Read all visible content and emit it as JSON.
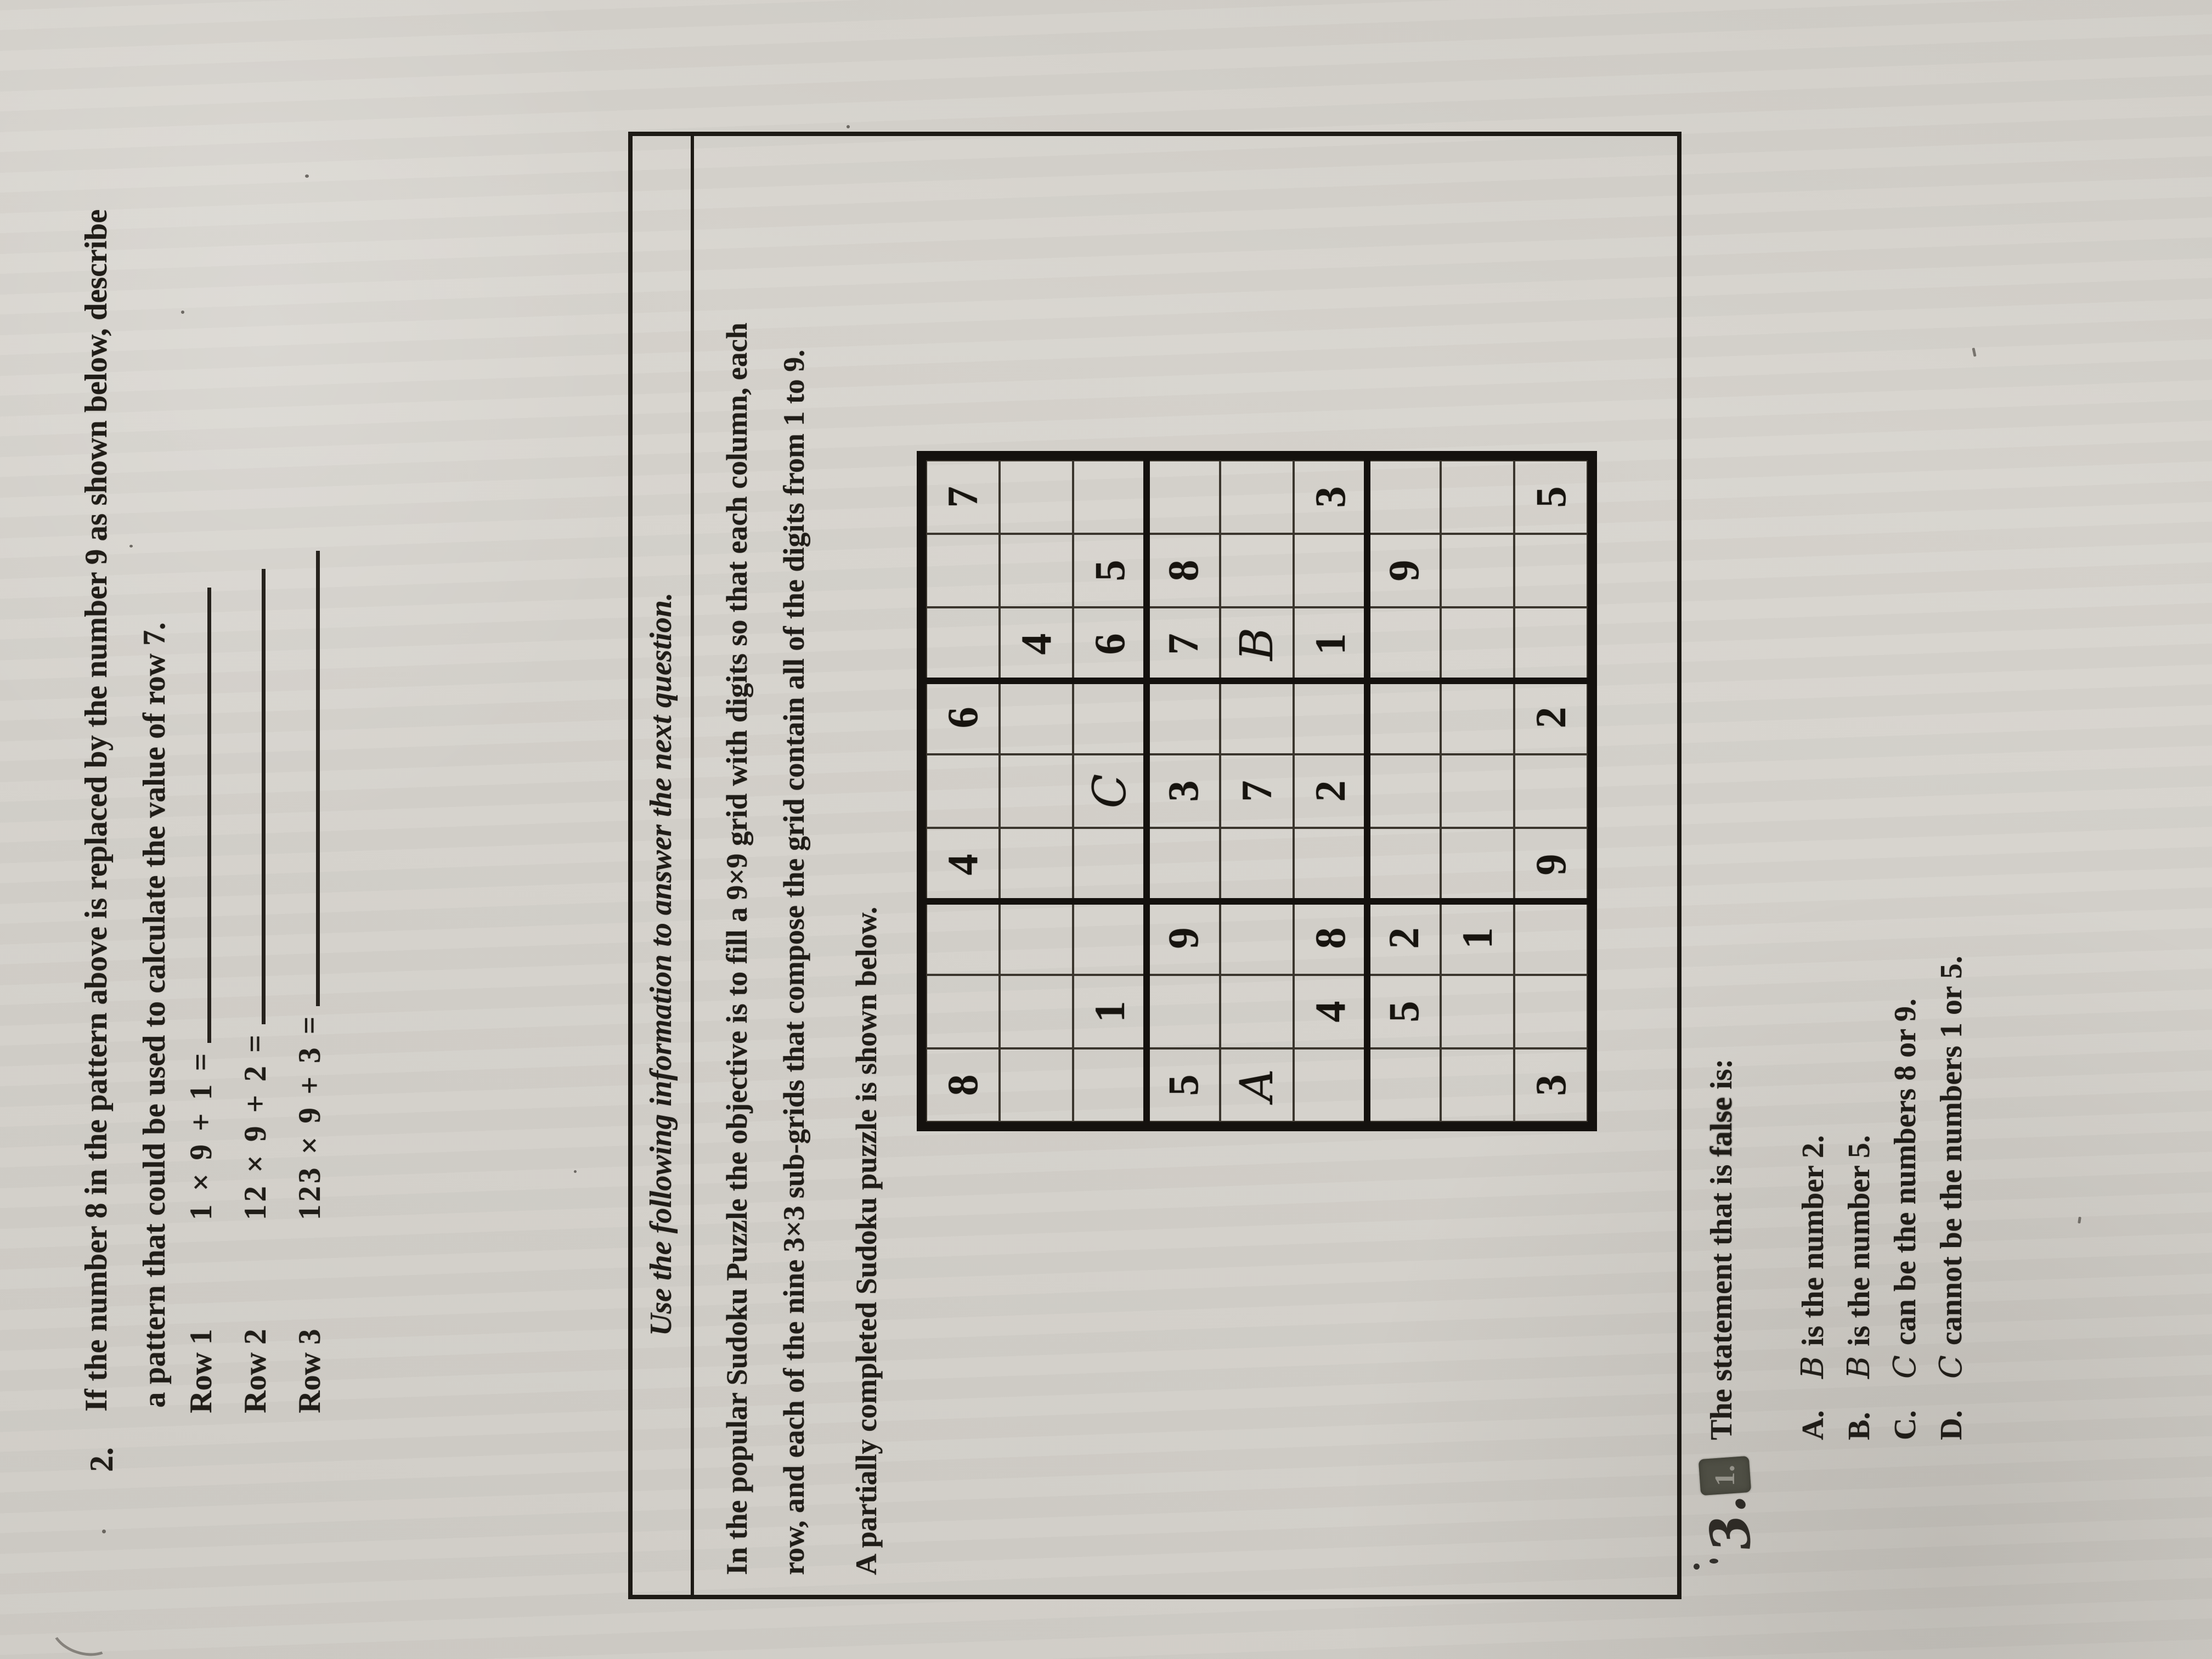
{
  "colors": {
    "paper": "#d3d0ca",
    "ink": "#201d18",
    "pencil_mark": "#4e4e44",
    "pen": "#2e2b26"
  },
  "question2": {
    "number": "2.",
    "line1": "If the number 8 in the pattern above is replaced by the number 9 as shown below, describe",
    "line2": "a pattern that could be used to calculate the value of row 7.",
    "rows": [
      {
        "label": "Row 1",
        "expression": "1 × 9 + 1 ="
      },
      {
        "label": "Row 2",
        "expression": "12 × 9 + 2 ="
      },
      {
        "label": "Row 3",
        "expression": "123 × 9 + 3 ="
      }
    ]
  },
  "info_box": {
    "heading": "Use the following information to answer the next question.",
    "line1": "In the popular Sudoku Puzzle the objective is to fill a 9×9 grid with digits so that each column, each",
    "line2": "row, and each of the nine 3×3 sub-grids that compose the grid contain all of the digits from 1 to 9.",
    "subtext": "A partially completed Sudoku puzzle is shown below."
  },
  "sudoku": {
    "grid": [
      [
        "8",
        "",
        "",
        "4",
        "",
        "6",
        "",
        "",
        "7"
      ],
      [
        "",
        "",
        "",
        "",
        "",
        "",
        "4",
        "",
        ""
      ],
      [
        "",
        "1",
        "",
        "",
        "C",
        "",
        "6",
        "5",
        ""
      ],
      [
        "5",
        "",
        "9",
        "",
        "3",
        "",
        "7",
        "8",
        ""
      ],
      [
        "A",
        "",
        "",
        "",
        "7",
        "",
        "B",
        "",
        ""
      ],
      [
        "",
        "4",
        "8",
        "",
        "2",
        "",
        "1",
        "",
        "3"
      ],
      [
        "",
        "5",
        "2",
        "",
        "",
        "",
        "",
        "9",
        ""
      ],
      [
        "",
        "",
        "1",
        "",
        "",
        "",
        "",
        "",
        ""
      ],
      [
        "3",
        "",
        "",
        "9",
        "",
        "2",
        "",
        "",
        "5"
      ]
    ]
  },
  "question3": {
    "number_handwritten": "3.",
    "covered_number": "1.",
    "stem_pre": "The statement that is ",
    "stem_bold": "false",
    "stem_post": " is:",
    "options": [
      {
        "letter": "A.",
        "subject": "B",
        "text": "is the number 2."
      },
      {
        "letter": "B.",
        "subject": "B",
        "text": "is the number 5."
      },
      {
        "letter": "C.",
        "subject": "C",
        "text": "can be the numbers 8 or 9."
      },
      {
        "letter": "D.",
        "subject": "C",
        "text": "cannot be the numbers 1 or 5."
      }
    ]
  }
}
